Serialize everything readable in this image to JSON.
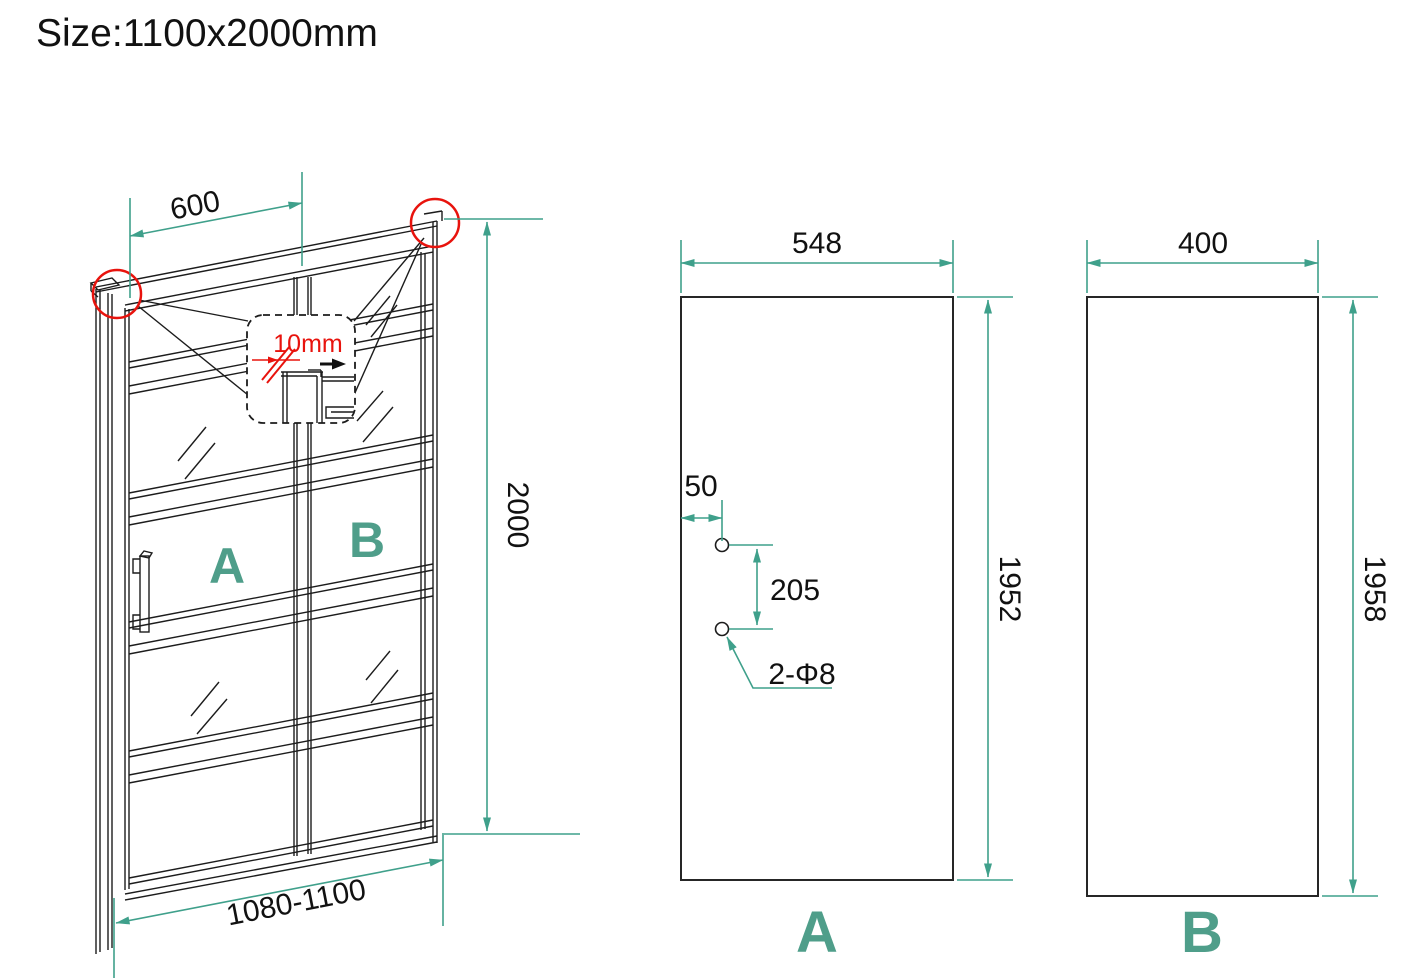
{
  "title": "Size:1100x2000mm",
  "colors": {
    "accent_teal": "#3FA08B",
    "label_teal": "#4F9E8A",
    "annotation_red": "#E8130D",
    "line_black": "#1C1C1C"
  },
  "door_3d": {
    "dim_top_width": "600",
    "dim_height": "2000",
    "dim_bottom_width": "1080-1100",
    "glass_thickness": "10mm",
    "panel_a_label": "A",
    "panel_b_label": "B"
  },
  "panel_a": {
    "label": "A",
    "dim_width": "548",
    "dim_height": "1952",
    "dim_hole_inset": "50",
    "dim_hole_spacing": "205",
    "holes_label": "2-Φ8"
  },
  "panel_b": {
    "label": "B",
    "dim_width": "400",
    "dim_height": "1958"
  }
}
